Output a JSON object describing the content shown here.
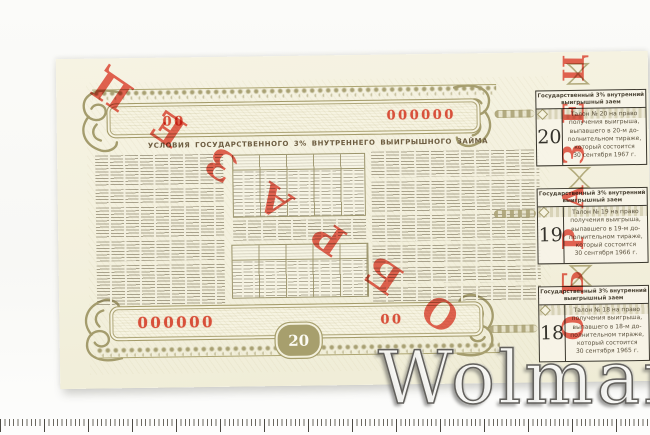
{
  "bond": {
    "title": "УСЛОВИЯ ГОСУДАРСТВЕННОГО 3% ВНУТРЕННЕГО ВЫИГРЫШНОГО ЗАЙМА",
    "denomination": "20",
    "specimen_stamp": "ОБРАЗЕЦ",
    "serials": {
      "top_left": "00",
      "top_right": "000000",
      "bottom_left": "000000",
      "bottom_right": "00"
    }
  },
  "coupons": {
    "header_line1": "Государственный 3% внутренний",
    "header_line2": "выигрышный заем",
    "items": [
      {
        "number": "20",
        "lines": [
          "Талон № 20 на право",
          "получения выигрыша,",
          "выпавшего в 20-м до-",
          "полнительном тираже,",
          "который состоится",
          "30 сентября 1967 г."
        ]
      },
      {
        "number": "19",
        "lines": [
          "Талон № 19 на право",
          "получения выигрыша,",
          "выпавшего в 19-м до-",
          "полнительном тираже,",
          "который состоится",
          "30 сентября 1966 г."
        ]
      },
      {
        "number": "18",
        "lines": [
          "Талон № 18 на право",
          "получения выигрыша,",
          "выпавшего в 18-м до-",
          "полнительном тираже,",
          "который состоится",
          "30 сентября 1965 г."
        ]
      }
    ]
  },
  "watermark": {
    "text": "Wolmar"
  },
  "colors": {
    "paper": "#f3f0dd",
    "ornament_olive": "#a49c6d",
    "text_sepia": "#6a6048",
    "serial_red": "#d8503a",
    "stamp_red": "#e2402e",
    "coupon_border": "#3b382e",
    "backdrop": "#fbfbf9"
  }
}
